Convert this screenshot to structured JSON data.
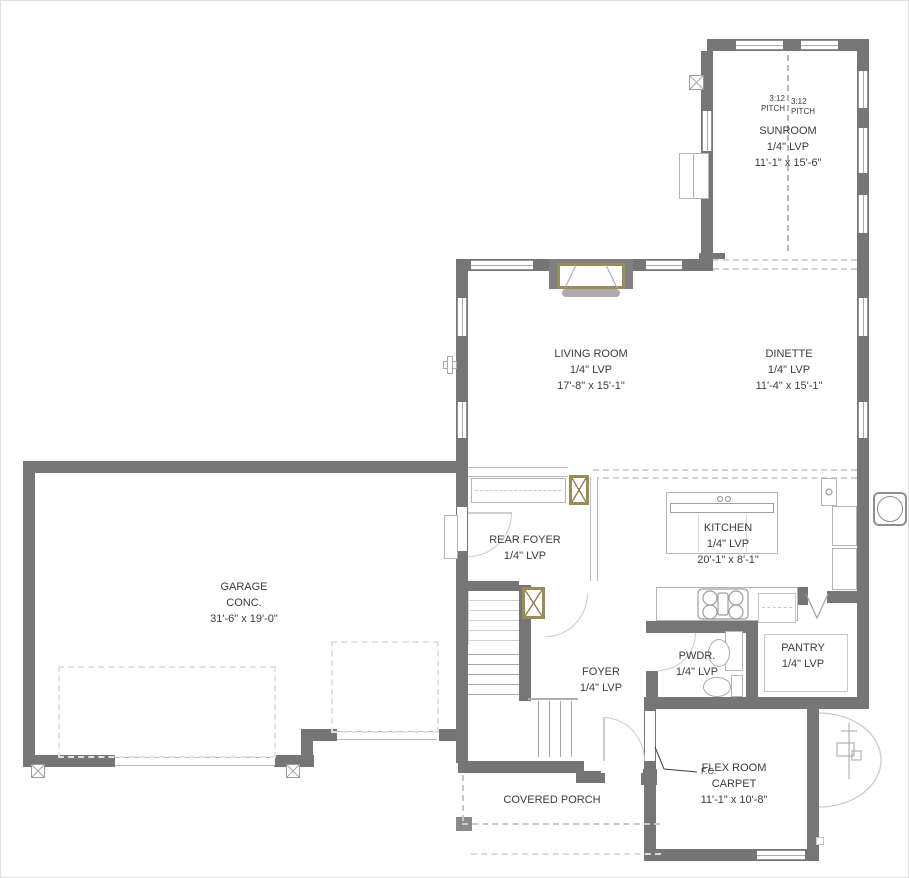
{
  "title": "First Floor Plan",
  "colors": {
    "wall": "#767676",
    "fixture_outline": "#b5b5b5",
    "accent_tan": "#9a8c56",
    "text": "#3c3c3c",
    "dashed_guide": "#d2d2d2"
  },
  "rooms": {
    "sunroom": {
      "name": "SUNROOM",
      "floor": "1/4\" LVP",
      "dims": "11'-1\" x 15'-6\""
    },
    "living_room": {
      "name": "LIVING ROOM",
      "floor": "1/4\" LVP",
      "dims": "17'-8\" x 15'-1\""
    },
    "dinette": {
      "name": "DINETTE",
      "floor": "1/4\" LVP",
      "dims": "11'-4\" x 15'-1\""
    },
    "kitchen": {
      "name": "KITCHEN",
      "floor": "1/4\" LVP",
      "dims": "20'-1\" x 8'-1\""
    },
    "rear_foyer": {
      "name": "REAR FOYER",
      "floor": "1/4\" LVP"
    },
    "garage": {
      "name": "GARAGE",
      "floor": "CONC.",
      "dims": "31'-6\" x 19'-0\""
    },
    "foyer": {
      "name": "FOYER",
      "floor": "1/4\" LVP"
    },
    "powder": {
      "name": "PWDR.",
      "floor": "1/4\" LVP"
    },
    "pantry": {
      "name": "PANTRY",
      "floor": "1/4\" LVP"
    },
    "flex_room": {
      "name": "FLEX ROOM",
      "floor": "CARPET",
      "dims": "11'-1\" x 10'-8\""
    },
    "covered_porch": {
      "name": "COVERED PORCH"
    }
  },
  "annotations": {
    "pitch_left": {
      "ratio": "3:12",
      "word": "PITCH"
    },
    "pitch_right": {
      "ratio": "3:12",
      "word": "PITCH"
    },
    "flex_note": "F.C."
  }
}
